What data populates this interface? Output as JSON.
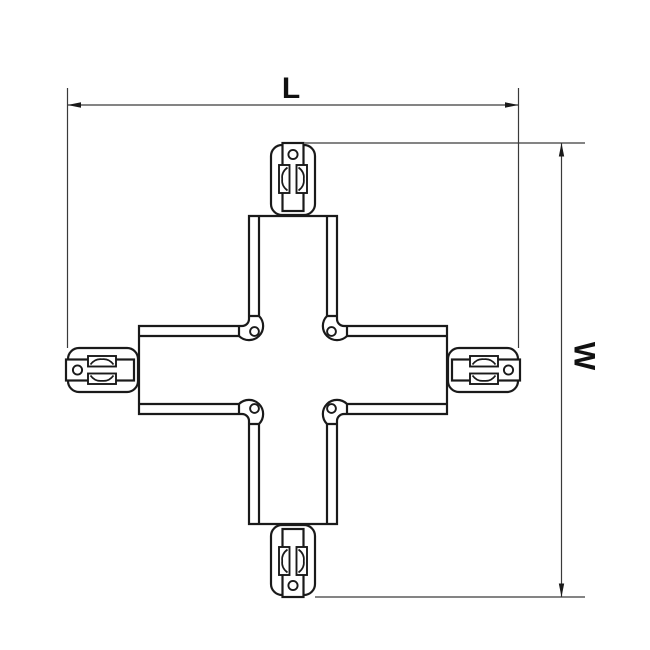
{
  "page": {
    "background_color": "#ffffff"
  },
  "drawing": {
    "kind": "dimensioned outline drawing of a 4-way X-shaped track connector",
    "dimensions": {
      "length": {
        "label": "L"
      },
      "width": {
        "label": "W"
      }
    },
    "colors": {
      "part_line": "#1a1a1a",
      "dimension_line": "#3a3a3a",
      "label_text": "#111111",
      "fill": "#ffffff"
    },
    "parts": {
      "connector_ends": 4,
      "corner_screw_holes": 4,
      "spring_clips_per_end": 2
    }
  }
}
